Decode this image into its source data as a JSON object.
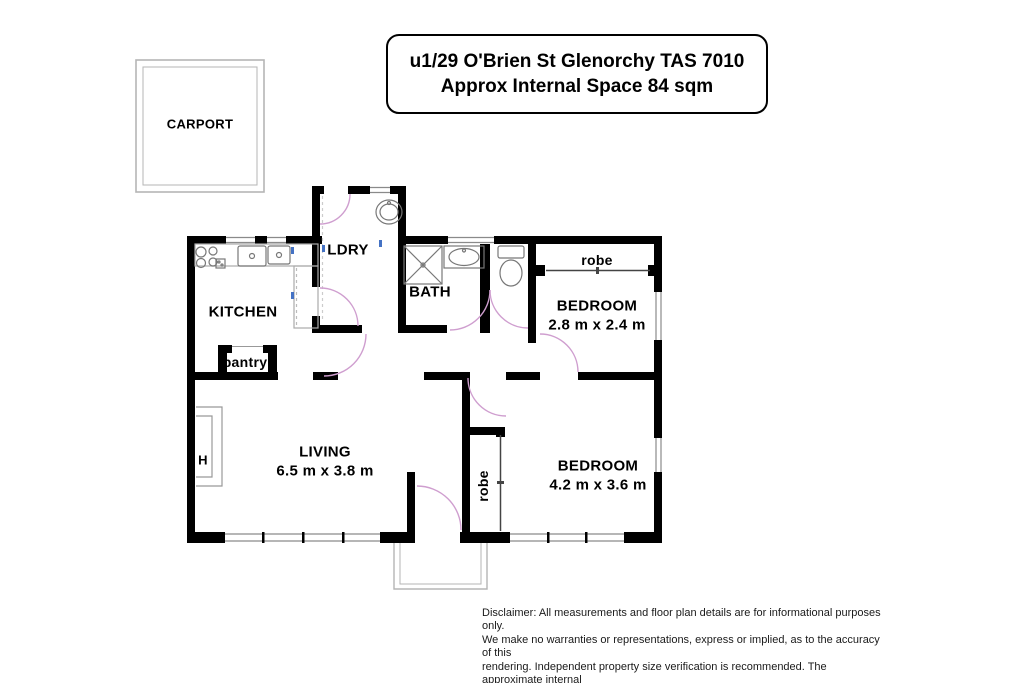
{
  "title_box": {
    "line1": "u1/29 O'Brien St Glenorchy TAS 7010",
    "line2": "Approx Internal Space 84 sqm"
  },
  "rooms": {
    "carport": "CARPORT",
    "kitchen": "KITCHEN",
    "pantry": "pantry",
    "laundry": "LDRY",
    "bath": "BATH",
    "living": {
      "name": "LIVING",
      "dims": "6.5 m x 3.8 m"
    },
    "bedroom1": {
      "name": "BEDROOM",
      "dims": "2.8 m x 2.4 m"
    },
    "bedroom2": {
      "name": "BEDROOM",
      "dims": "4.2 m x 3.6 m"
    },
    "robe1": "robe",
    "robe2": "robe",
    "heater": "H"
  },
  "disclaimer": {
    "line1": "Disclaimer: All measurements and floor plan details are for informational purposes only.",
    "line2": "We  make no warranties or representations, express or implied, as to the accuracy of this",
    "line3": "rendering. Independent property size verification is recommended. The approximate internal",
    "line4": "area measurement does not directly reflect the goverment evaluation of the property area."
  },
  "colors": {
    "wall": "#000000",
    "door_arc": "#cf9ecf",
    "window": "#8a8a8a",
    "fixture": "#777777",
    "outline": "#b5b5b5",
    "marker": "#4472c4"
  }
}
